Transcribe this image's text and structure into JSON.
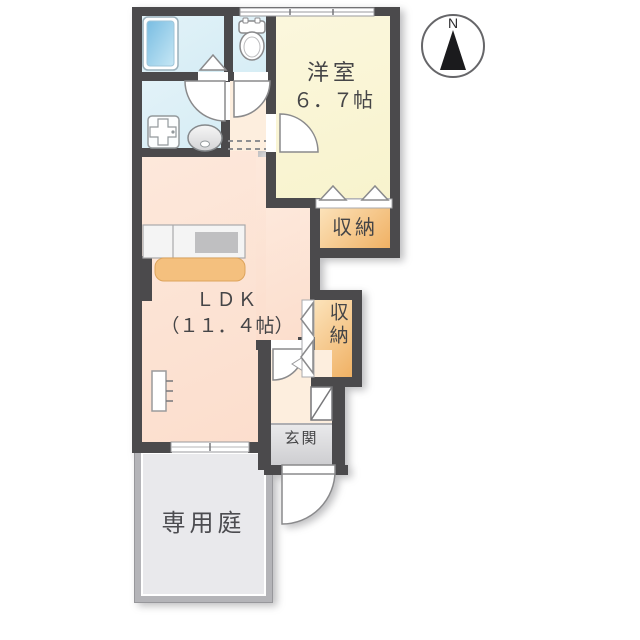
{
  "compass": {
    "label": "N"
  },
  "rooms": {
    "bedroom": {
      "name": "洋室",
      "size": "６．７帖"
    },
    "ldk": {
      "name": "ＬＤＫ",
      "size": "（１１．４帖）"
    },
    "closet_upper": {
      "label": "収納"
    },
    "closet_lower": {
      "label": "収納"
    },
    "entrance": {
      "label": "玄関"
    },
    "garden": {
      "label": "専用庭"
    }
  },
  "colors": {
    "wall": "#4b4a4c",
    "bath": "#d6edf5",
    "bedroom": "#f8f3cd",
    "ldk": "#fcdecd",
    "hall": "#fdeede",
    "closet_light": "#fce3bb",
    "closet_dark": "#f0b164",
    "genkan_light": "#e9e9eb",
    "genkan_dark": "#cbcbce",
    "garden": "#e9e9ec",
    "garden_border": "#b4b4b8",
    "tub_light": "#c6e7f5",
    "tub_dark": "#79bde2",
    "line": "#8a8a8c",
    "text": "#454547"
  }
}
